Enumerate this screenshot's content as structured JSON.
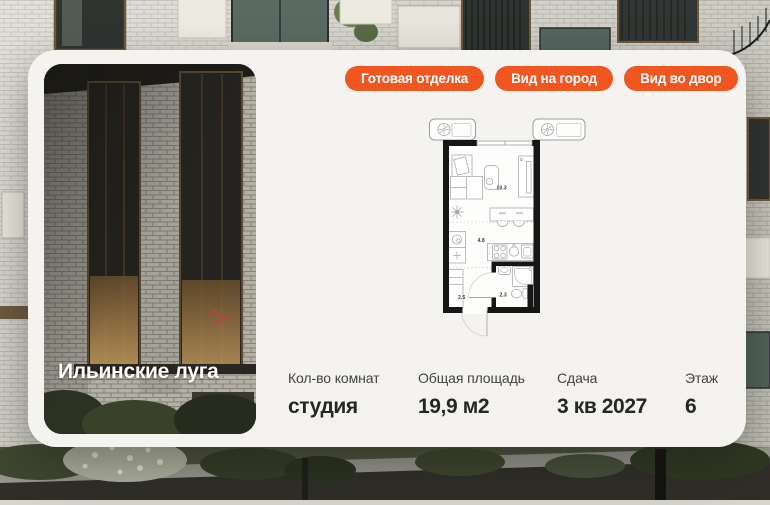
{
  "project": {
    "name": "Ильинские луга"
  },
  "badges": [
    {
      "label": "Готовая отделка"
    },
    {
      "label": "Вид на город"
    },
    {
      "label": "Вид во двор"
    }
  ],
  "floorplan": {
    "areas": [
      {
        "room": "main-room",
        "value": "10.3"
      },
      {
        "room": "kitchen",
        "value": "4.8"
      },
      {
        "room": "hallway",
        "value": "2.5"
      },
      {
        "room": "bathroom",
        "value": "2.3"
      }
    ]
  },
  "specs": [
    {
      "label": "Кол-во комнат",
      "value": "студия"
    },
    {
      "label": "Общая площадь",
      "value": "19,9 м2"
    },
    {
      "label": "Сдача",
      "value": "3 кв 2027"
    },
    {
      "label": "Этаж",
      "value": "6"
    }
  ],
  "colors": {
    "accent": "#f0561f",
    "card_bg": "#f5f3ef",
    "text_dark": "#262626",
    "plan_wall": "#161616"
  }
}
